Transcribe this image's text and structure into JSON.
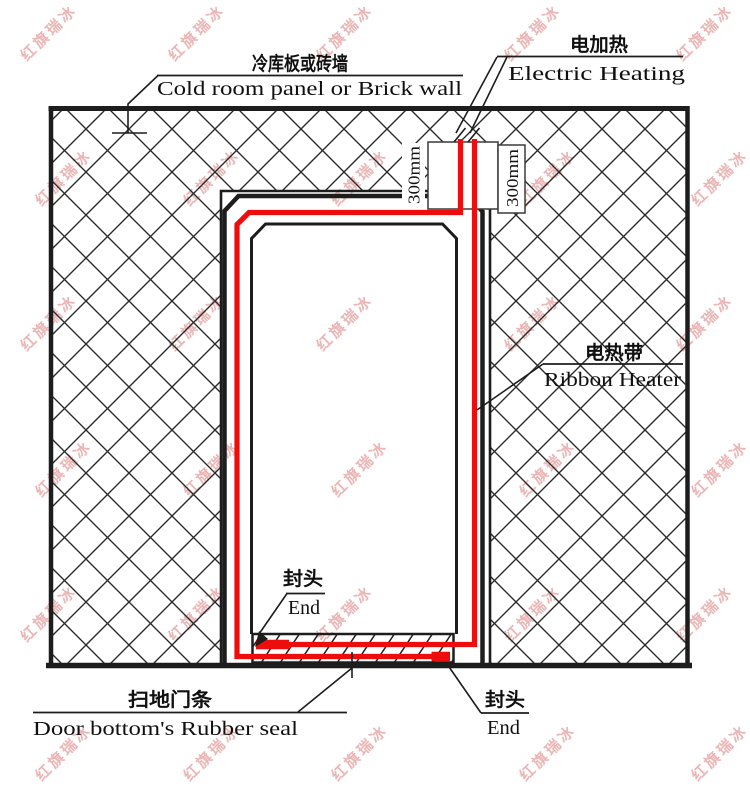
{
  "diagram": {
    "labels": {
      "wall": {
        "zh": "冷库板或砖墙",
        "en": "Cold room panel or Brick wall"
      },
      "heating": {
        "zh": "电加热",
        "en": "Electric Heating"
      },
      "ribbon": {
        "zh": "电热带",
        "en": "Ribbon Heater"
      },
      "end_left": {
        "zh": "封头",
        "en": "End"
      },
      "end_right": {
        "zh": "封头",
        "en": "End"
      },
      "seal": {
        "zh": "扫地门条",
        "en": "Door bottom's Rubber seal"
      }
    },
    "dimensions": {
      "left": "300mm",
      "right": "300mm"
    },
    "colors": {
      "heater_red": "#ee0d0d",
      "line_black": "#1d1d1d",
      "watermark_pink": "#d96e6e"
    }
  },
  "watermark": {
    "text": "红旗瑞冰",
    "opacity": 0.5,
    "grid": {
      "cols_x": [
        48,
        196,
        344,
        532,
        704
      ],
      "rows_y": [
        32,
        177,
        322,
        468,
        613,
        752
      ],
      "odd_row_shift": 15
    }
  }
}
